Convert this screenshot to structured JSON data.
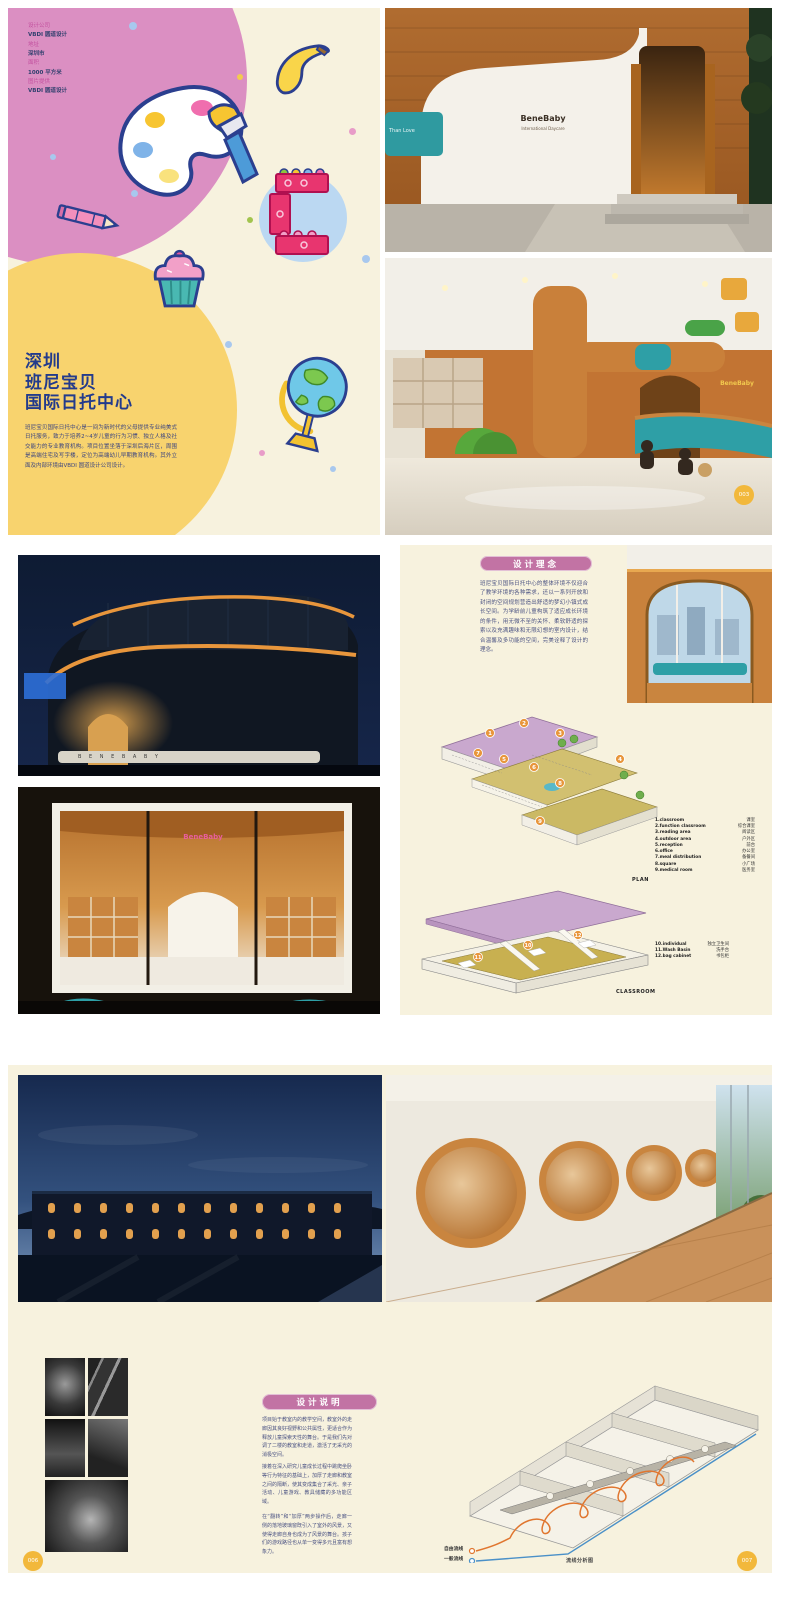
{
  "document": {
    "type": "design-portfolio-spread",
    "project": "深圳班尼宝贝国际日托中心"
  },
  "colors": {
    "page_cream": "#F7F2DE",
    "pink_circle": "#DB8FC2",
    "yellow_circle": "#F8D36E",
    "title_navy": "#233B8C",
    "body_navy": "#4A5283",
    "heading_pill": "#C273A4",
    "badge_gold": "#F2B83B",
    "flow_free": "#E0762F",
    "flow_general": "#4A90C8"
  },
  "spread1": {
    "info_lines": [
      {
        "text": "设计公司"
      },
      {
        "text": "VBDI 圆道设计"
      },
      {
        "text": "地址"
      },
      {
        "text": "深圳市"
      },
      {
        "text": "面积"
      },
      {
        "text": "1000 平方米"
      },
      {
        "text": "图片提供"
      },
      {
        "text": "VBDI 圆道设计"
      }
    ],
    "title_lines": [
      "深圳",
      "班尼宝贝",
      "国际日托中心"
    ],
    "intro": "班尼宝贝国际日托中心是一间为新时代的父母提供专业纯美式日托服务，致力于培养2~4岁儿童的行为习惯、独立人格及社交能力的专业教育机构。项目位置坐落于深圳后海片区，周围是高端住宅及写字楼，定位为高端幼儿早期教育机构。其外立面及内部环境由VBDI 圆道设计公司设计。",
    "badge": "003",
    "photo_exterior": {
      "sign": "BeneBaby",
      "sign_sub": "International Daycare",
      "teal_sign": "Than Love"
    },
    "photo_interior": {
      "logo": "BeneBaby"
    }
  },
  "spread2": {
    "heading": "设计理念",
    "concept": "班尼宝贝国际日托中心的整体环境不仅迎合了教学环境的各种需求，还以一系列开放和封闭的空间规划营造出舒适的梦幻小镇式成长空间。为学龄前儿童构筑了适应成长环境的条件，用无微不至的关怀、柔软舒适的探索以及充满趣味和无限幻想的室内设计，结合温馨及多功能的空间，完美诠释了设计的理念。",
    "night_letters": "B E N E B A B Y",
    "storefront_sign": "BeneBaby",
    "plan_label": "PLAN",
    "classroom_label": "CLASSROOM",
    "plan_legend": [
      {
        "num": "1",
        "en": "1.classroom",
        "cn": "课室"
      },
      {
        "num": "2",
        "en": "2.function classroom",
        "cn": "综合课室"
      },
      {
        "num": "3",
        "en": "3.reading area",
        "cn": "阅读区"
      },
      {
        "num": "4",
        "en": "4.outdoor area",
        "cn": "户外区"
      },
      {
        "num": "5",
        "en": "5.reception",
        "cn": "前台"
      },
      {
        "num": "6",
        "en": "6.office",
        "cn": "办公室"
      },
      {
        "num": "7",
        "en": "7.meal distribution",
        "cn": "备餐间"
      },
      {
        "num": "8",
        "en": "8.square",
        "cn": "小广场"
      },
      {
        "num": "9",
        "en": "9.medical room",
        "cn": "医务室"
      }
    ],
    "classroom_legend": [
      {
        "num": "10",
        "en": "10.individual",
        "cn": "独立卫生间"
      },
      {
        "num": "11",
        "en": "11.Wash Basin",
        "cn": "洗手台"
      },
      {
        "num": "12",
        "en": "12.bag cabinet",
        "cn": "书包柜"
      }
    ]
  },
  "spread3": {
    "heading": "设计说明",
    "paragraphs": [
      "项目始于教室内的教学空间，教室外的走廊因其良好视野和公共属性，更适合作为释放儿童探索天性的舞台。于是我们先对调了二楼的教室和走道，激活了无采光的消极空间。",
      "接着在深入研究儿童成长过程中跳爬坐卧等行为特征的基础上，加厚了走廊和教室之间的隔断，使其变成集合了采光、亲子活动、儿童游戏、教具储藏的多功能区域。",
      "在“翻转”和“加厚”两步操作后，走廊一侧的落地玻璃窗既引入了室外的风景，又使得走廊自身也成为了风景的舞台。孩子们的游戏路径也从单一变得多元且富有想象力。"
    ],
    "flow_legend": [
      {
        "label": "自由流线"
      },
      {
        "label": "一般流线"
      }
    ],
    "flow_caption": "流线分析图",
    "badge_left": "006",
    "badge_right": "007"
  }
}
